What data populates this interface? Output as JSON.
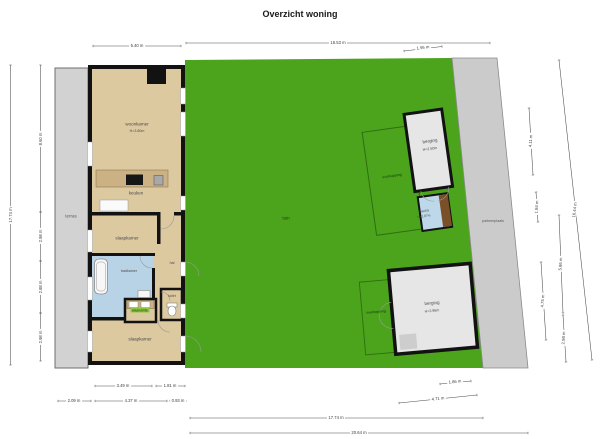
{
  "title": "Overzicht woning",
  "rooms": {
    "terras": "terras",
    "woonkamer": {
      "name": "woonkamer",
      "height": "H=3.80m"
    },
    "keuken": "keuken",
    "slaapkamer_midden": "slaapkamer",
    "hal": "hal",
    "badkamer": "badkamer",
    "wasruimte": "wasruimte",
    "toilet": "toilet",
    "slaapkamer_onder": "slaapkamer",
    "tuin": "tuin",
    "berging_noord": {
      "name": "berging",
      "height": "H=2.50m"
    },
    "overkapping_noord": "overkapping",
    "sauna": {
      "name": "sauna",
      "height": "H=1.87m"
    },
    "parkeerplaats": "parkeerplaats",
    "berging_zuid": {
      "name": "berging",
      "height": "H=2.96m"
    },
    "overkapping_zuid": "overkapping"
  },
  "dimensions": {
    "top": [
      "5.40 m",
      "16.53 m",
      "1.95 m"
    ],
    "left": [
      "17.74 m",
      "8.60 m",
      "2.98 m",
      "2.88 m",
      "2.98 m"
    ],
    "right": [
      "4.11 m",
      "1.84 m",
      "4.75 m",
      "5.86 m",
      "2.98 m",
      "16.44 m"
    ],
    "bottom": [
      "3.49 m",
      "1.81 m",
      "1.86 m",
      "2.09 m",
      "4.37 m",
      "0.93 m",
      "4.71 m",
      "17.74 m",
      "20.64 m"
    ]
  },
  "colors": {
    "garden_green": "#4BA41C",
    "floor_tan": "#DDC9A0",
    "bathroom_blue": "#B9D3E6",
    "paving_gray": "#CFCFCF",
    "wall_black": "#121212",
    "sauna_wood": "#7B4F28",
    "label_chip_green": "#8CC63E"
  }
}
